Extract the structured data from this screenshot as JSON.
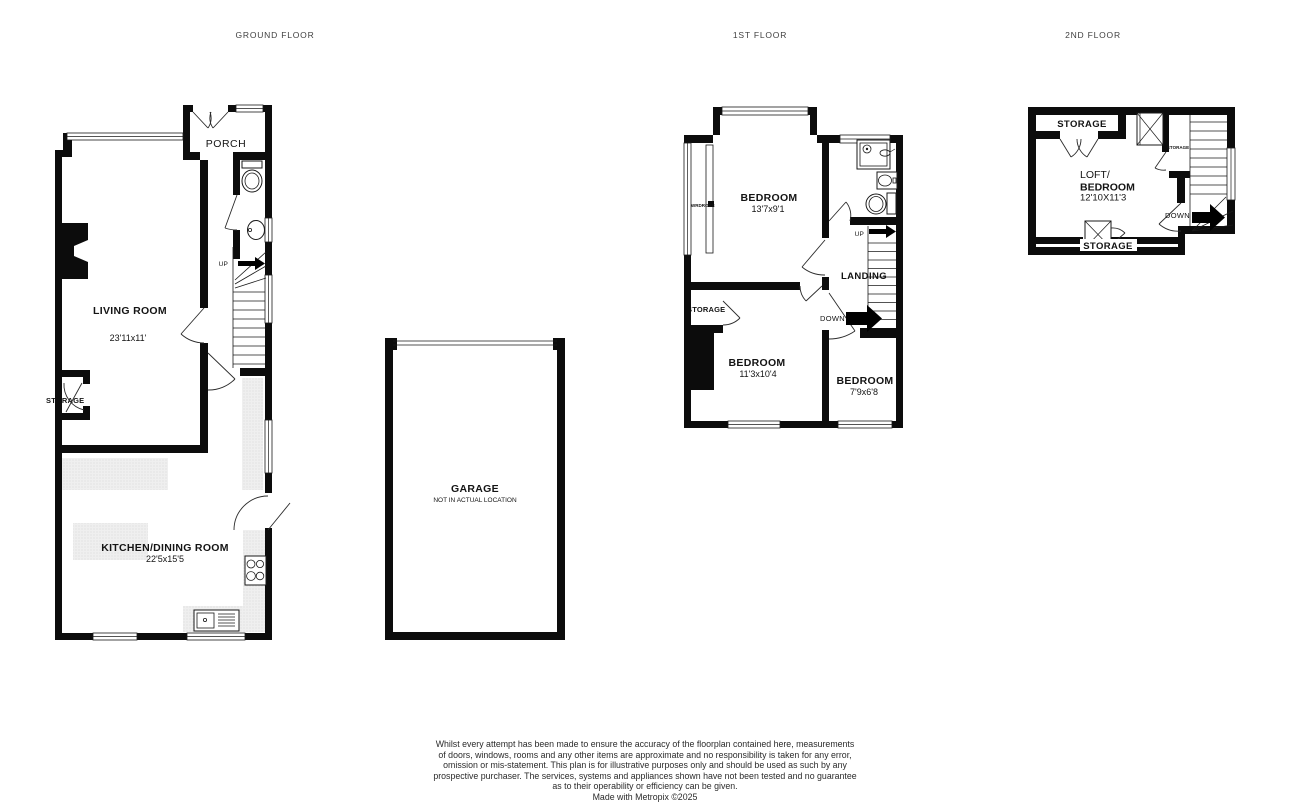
{
  "floors": {
    "ground": {
      "title": "GROUND FLOOR",
      "porch": "PORCH",
      "living_name": "LIVING ROOM",
      "living_dims": "23'11x11'",
      "kitchen_name": "KITCHEN/DINING ROOM",
      "kitchen_dims": "22'5x15'5",
      "storage": "STORAGE",
      "up": "UP"
    },
    "garage": {
      "name": "GARAGE",
      "note": "NOT IN ACTUAL LOCATION"
    },
    "first": {
      "title": "1ST FLOOR",
      "bedroom1_name": "BEDROOM",
      "bedroom1_dims": "13'7x9'1",
      "bedroom2_name": "BEDROOM",
      "bedroom2_dims": "11'3x10'4",
      "bedroom3_name": "BEDROOM",
      "bedroom3_dims": "7'9x6'8",
      "landing": "LANDING",
      "storage": "STORAGE",
      "wardrobe": "WRDROBE",
      "up": "UP",
      "down": "DOWN"
    },
    "second": {
      "title": "2ND FLOOR",
      "loft_line1": "LOFT/",
      "loft_line2": "BEDROOM",
      "loft_dims": "12'10X11'3",
      "storage_top": "STORAGE",
      "storage_small": "STORAGE",
      "storage_bottom": "STORAGE",
      "down": "DOWN"
    }
  },
  "disclaimer": {
    "lines": [
      "Whilst every attempt has been made to ensure the accuracy of the floorplan contained here, measurements",
      "of doors, windows, rooms and any other items are approximate and no responsibility is taken for any error,",
      "omission or mis-statement. This plan is for illustrative purposes only and should be used as such by any",
      "prospective purchaser. The services, systems and appliances shown have not been tested and no guarantee",
      "as to their operability or efficiency can be given."
    ],
    "credit": "Made with Metropix ©2025"
  },
  "colors": {
    "wall": "#0c0c0c",
    "hatch": "#efefef",
    "background": "#ffffff"
  }
}
